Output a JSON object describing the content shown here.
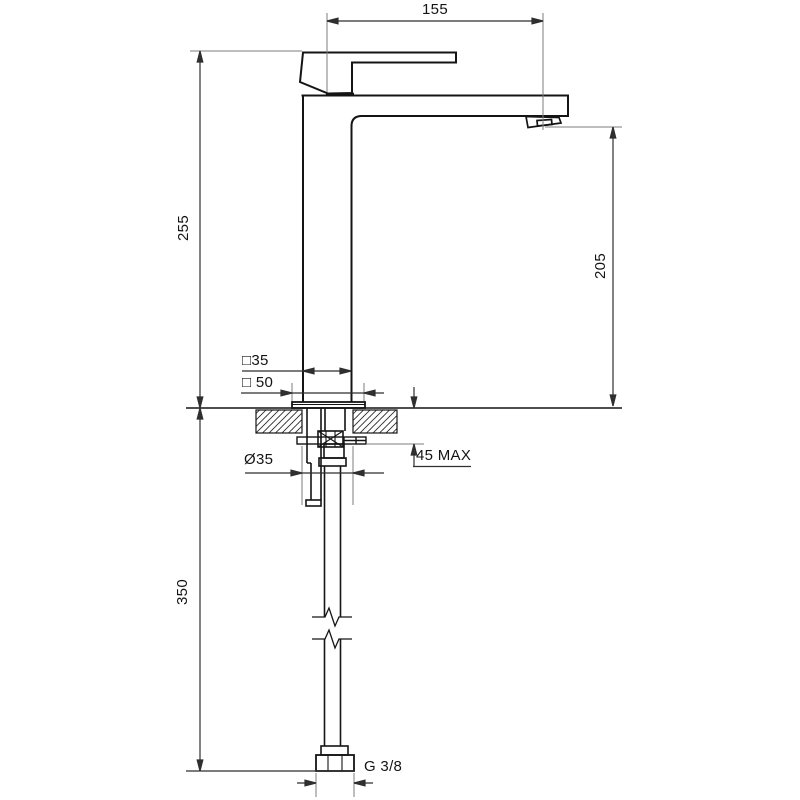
{
  "drawing": {
    "type": "faucet-installation-technical-drawing",
    "background": "#ffffff",
    "object_line_color": "#141414",
    "dimension_line_color": "#2f2f2f",
    "extension_line_color": "#7d7d7d",
    "labels": {
      "spout_reach": "155",
      "body_height": "255",
      "spout_height": "205",
      "hose_length": "350",
      "body_section_square": "□35",
      "base_square": "□ 50",
      "hole_diameter": "Ø35",
      "max_deck_thickness": "45 MAX",
      "connection_thread": "G 3/8"
    }
  }
}
